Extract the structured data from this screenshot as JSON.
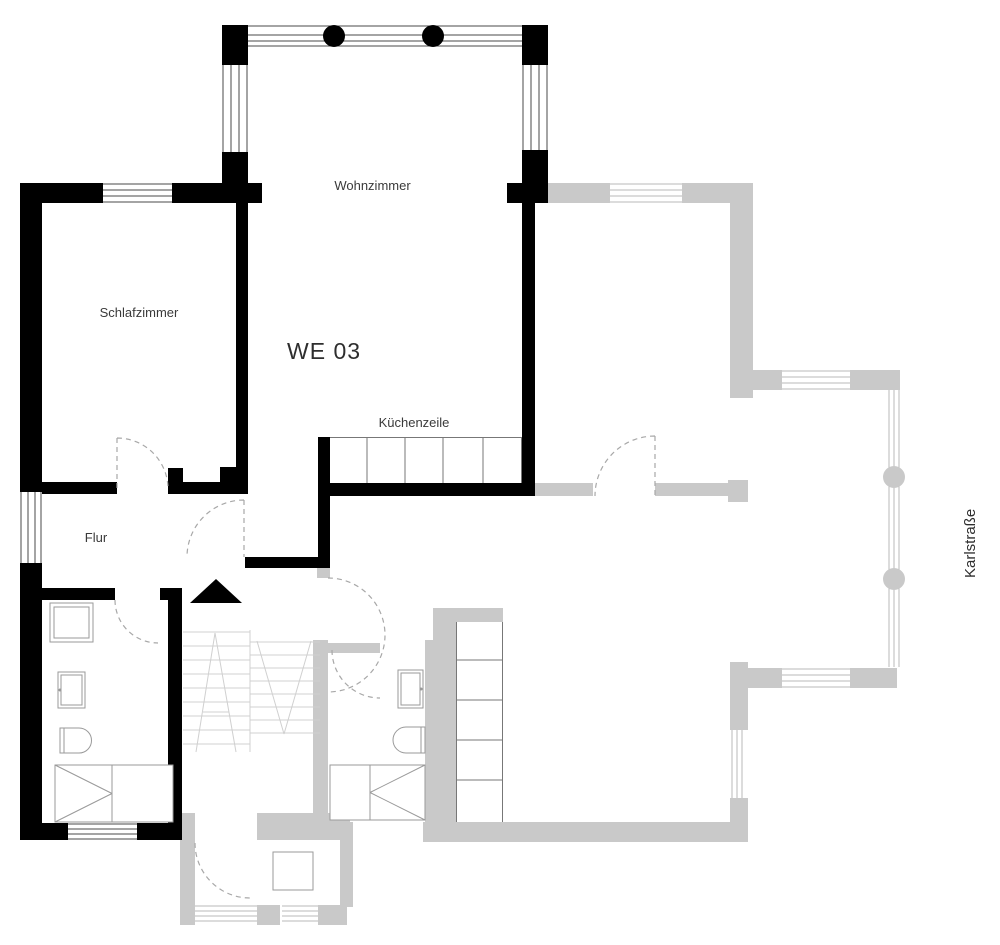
{
  "unit_label": "WE 03",
  "street_label": "Karlstraße",
  "rooms": {
    "living": "Wohnzimmer",
    "bedroom": "Schlafzimmer",
    "hall": "Flur",
    "kitchenette": "Küchenzeile"
  },
  "colors": {
    "unit_wall": "#000000",
    "neighbor_wall": "#c9c9c9",
    "stair_line": "#d0d0d0",
    "door_arc": "#a8a8a8",
    "fixture_line": "#9a9a9a",
    "window_line_dark": "#4a4a4a",
    "window_line_light": "#b8b8b8",
    "label_text": "#3a3a3a",
    "background": "#ffffff"
  }
}
